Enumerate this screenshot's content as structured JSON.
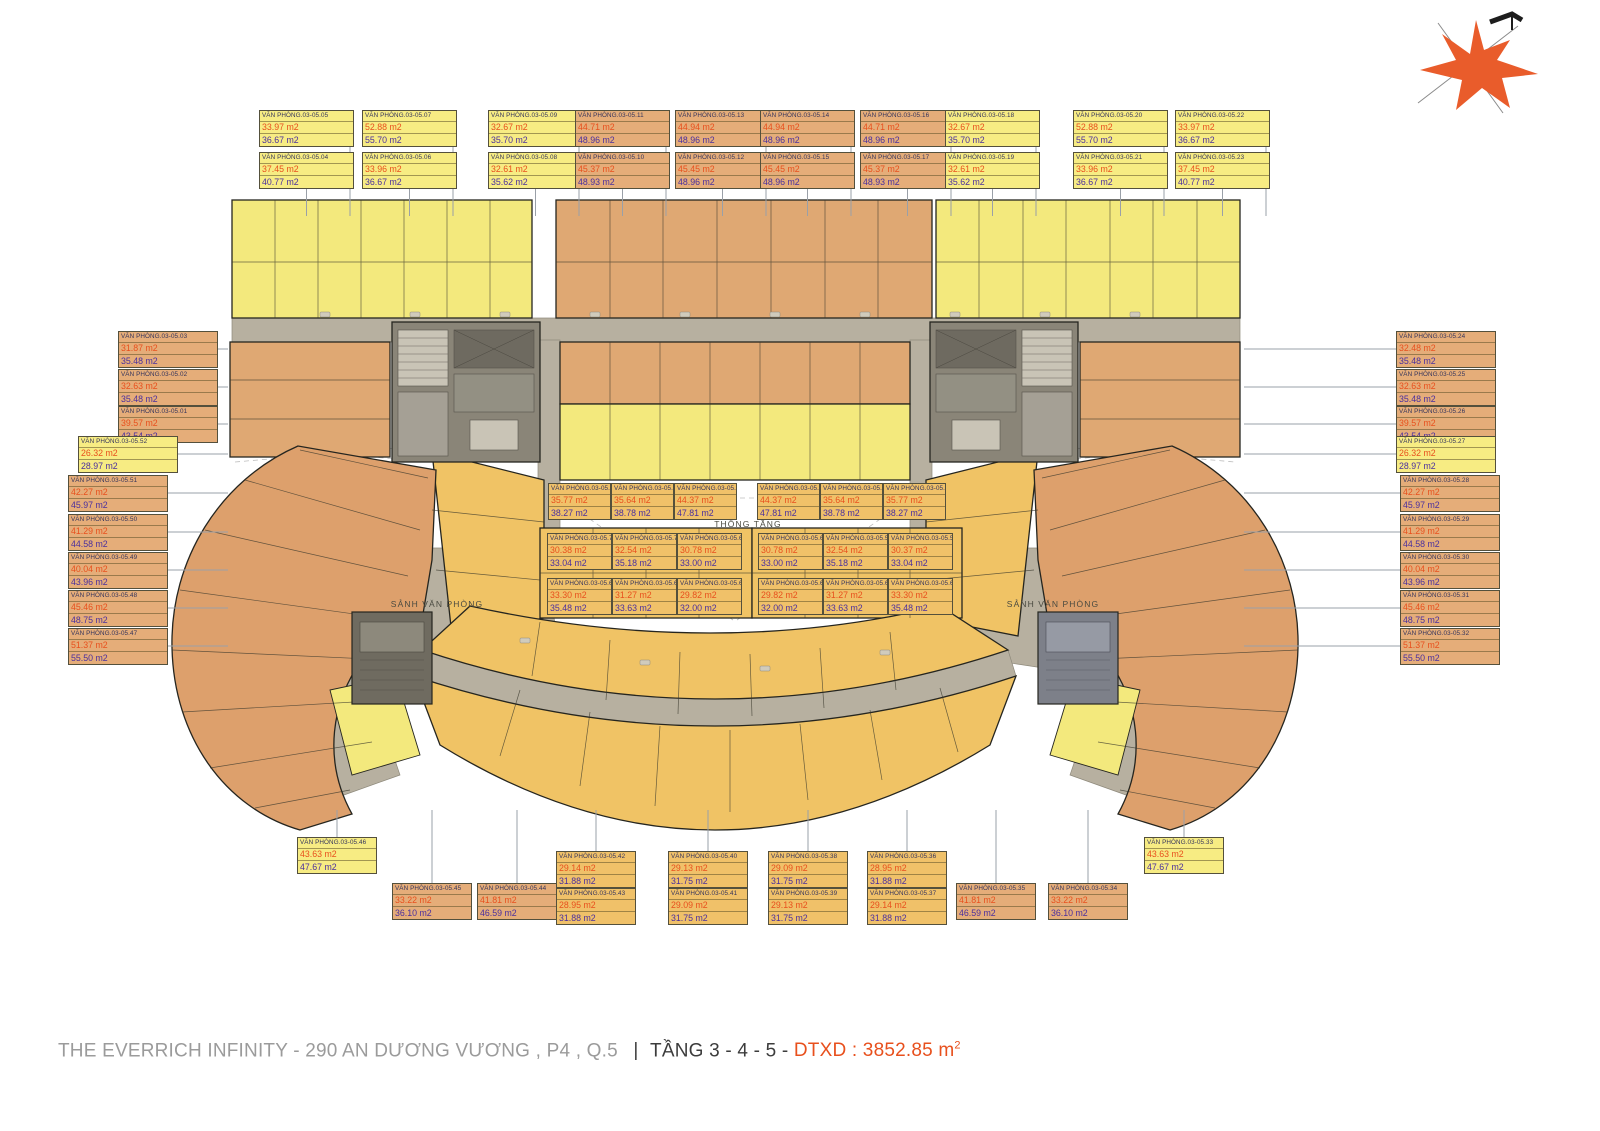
{
  "footer": {
    "project": "THE EVERRICH INFINITY - 290 AN DƯƠNG VƯƠNG , P4 , Q.5",
    "floor": "TẦNG 3 - 4 - 5 - ",
    "dtxd": "DTXD : 3852.85 m",
    "dtxd_sup": "2"
  },
  "colors": {
    "label_yellow": "#f7ec83",
    "label_orange": "#e5ad79",
    "label_golden": "#f0c169",
    "area1_text": "#e8501d",
    "area2_text": "#4a2f9e",
    "name_text": "#33335c",
    "unit_yellow": "#f3e97d",
    "unit_orange": "#dfa873",
    "wing_orange": "#dda06c",
    "unit_golden": "#f0c365",
    "corridor": "#b7b0a0",
    "core": "#8a8578",
    "compass": "#e95c2b",
    "leader": "#9aa0a8"
  },
  "plan_texts": [
    {
      "text": "THÔNG TẦNG",
      "x": 748,
      "y": 524
    },
    {
      "text": "SẢNH VĂN PHÒNG",
      "x": 437,
      "y": 604
    },
    {
      "text": "SẢNH VĂN PHÒNG",
      "x": 1053,
      "y": 604
    }
  ],
  "labels": [
    {
      "id": "VĂN PHÒNG.03-05.05",
      "a1": "33.97 m2",
      "a2": "36.67 m2",
      "c": "yellow",
      "x": 259,
      "y": 110,
      "w": 95,
      "leader": "down"
    },
    {
      "id": "VĂN PHÒNG.03-05.07",
      "a1": "52.88 m2",
      "a2": "55.70 m2",
      "c": "yellow",
      "x": 362,
      "y": 110,
      "w": 95,
      "leader": "down"
    },
    {
      "id": "VĂN PHÒNG.03-05.09",
      "a1": "32.67 m2",
      "a2": "35.70 m2",
      "c": "yellow",
      "x": 488,
      "y": 110,
      "w": 95,
      "leader": "down"
    },
    {
      "id": "VĂN PHÒNG.03-05.11",
      "a1": "44.71 m2",
      "a2": "48.96 m2",
      "c": "orange",
      "x": 575,
      "y": 110,
      "w": 95,
      "leader": "down"
    },
    {
      "id": "VĂN PHÒNG.03-05.13",
      "a1": "44.94 m2",
      "a2": "48.96 m2",
      "c": "orange",
      "x": 675,
      "y": 110,
      "w": 95,
      "leader": "down"
    },
    {
      "id": "VĂN PHÒNG.03-05.14",
      "a1": "44.94 m2",
      "a2": "48.96 m2",
      "c": "orange",
      "x": 760,
      "y": 110,
      "w": 95,
      "leader": "down"
    },
    {
      "id": "VĂN PHÒNG.03-05.16",
      "a1": "44.71 m2",
      "a2": "48.96 m2",
      "c": "orange",
      "x": 860,
      "y": 110,
      "w": 95,
      "leader": "down"
    },
    {
      "id": "VĂN PHÒNG.03-05.18",
      "a1": "32.67 m2",
      "a2": "35.70 m2",
      "c": "yellow",
      "x": 945,
      "y": 110,
      "w": 95,
      "leader": "down"
    },
    {
      "id": "VĂN PHÒNG.03-05.20",
      "a1": "52.88 m2",
      "a2": "55.70 m2",
      "c": "yellow",
      "x": 1073,
      "y": 110,
      "w": 95,
      "leader": "down"
    },
    {
      "id": "VĂN PHÒNG.03-05.22",
      "a1": "33.97 m2",
      "a2": "36.67 m2",
      "c": "yellow",
      "x": 1175,
      "y": 110,
      "w": 95,
      "leader": "down"
    },
    {
      "id": "VĂN PHÒNG.03-05.04",
      "a1": "37.45 m2",
      "a2": "40.77 m2",
      "c": "yellow",
      "x": 259,
      "y": 152,
      "w": 95,
      "leader": "down"
    },
    {
      "id": "VĂN PHÒNG.03-05.06",
      "a1": "33.96 m2",
      "a2": "36.67 m2",
      "c": "yellow",
      "x": 362,
      "y": 152,
      "w": 95,
      "leader": "down"
    },
    {
      "id": "VĂN PHÒNG.03-05.08",
      "a1": "32.61 m2",
      "a2": "35.62 m2",
      "c": "yellow",
      "x": 488,
      "y": 152,
      "w": 95,
      "leader": "down"
    },
    {
      "id": "VĂN PHÒNG.03-05.10",
      "a1": "45.37 m2",
      "a2": "48.93 m2",
      "c": "orange",
      "x": 575,
      "y": 152,
      "w": 95,
      "leader": "down"
    },
    {
      "id": "VĂN PHÒNG.03-05.12",
      "a1": "45.45 m2",
      "a2": "48.96 m2",
      "c": "orange",
      "x": 675,
      "y": 152,
      "w": 95,
      "leader": "down"
    },
    {
      "id": "VĂN PHÒNG.03-05.15",
      "a1": "45.45 m2",
      "a2": "48.96 m2",
      "c": "orange",
      "x": 760,
      "y": 152,
      "w": 95,
      "leader": "down"
    },
    {
      "id": "VĂN PHÒNG.03-05.17",
      "a1": "45.37 m2",
      "a2": "48.93 m2",
      "c": "orange",
      "x": 860,
      "y": 152,
      "w": 95,
      "leader": "down"
    },
    {
      "id": "VĂN PHÒNG.03-05.19",
      "a1": "32.61 m2",
      "a2": "35.62 m2",
      "c": "yellow",
      "x": 945,
      "y": 152,
      "w": 95,
      "leader": "down"
    },
    {
      "id": "VĂN PHÒNG.03-05.21",
      "a1": "33.96 m2",
      "a2": "36.67 m2",
      "c": "yellow",
      "x": 1073,
      "y": 152,
      "w": 95,
      "leader": "down"
    },
    {
      "id": "VĂN PHÒNG.03-05.23",
      "a1": "37.45 m2",
      "a2": "40.77 m2",
      "c": "yellow",
      "x": 1175,
      "y": 152,
      "w": 95,
      "leader": "down"
    },
    {
      "id": "VĂN PHÒNG.03-05.03",
      "a1": "31.87 m2",
      "a2": "35.48 m2",
      "c": "orange",
      "x": 118,
      "y": 331,
      "w": 100,
      "leader": "right"
    },
    {
      "id": "VĂN PHÒNG.03-05.02",
      "a1": "32.63 m2",
      "a2": "35.48 m2",
      "c": "orange",
      "x": 118,
      "y": 369,
      "w": 100,
      "leader": "right"
    },
    {
      "id": "VĂN PHÒNG.03-05.01",
      "a1": "39.57 m2",
      "a2": "43.54 m2",
      "c": "orange",
      "x": 118,
      "y": 406,
      "w": 100,
      "leader": "right"
    },
    {
      "id": "VĂN PHÒNG.03-05.52",
      "a1": "26.32 m2",
      "a2": "28.97 m2",
      "c": "yellow",
      "x": 78,
      "y": 436,
      "w": 100,
      "leader": "right"
    },
    {
      "id": "VĂN PHÒNG.03-05.51",
      "a1": "42.27 m2",
      "a2": "45.97 m2",
      "c": "orange",
      "x": 68,
      "y": 475,
      "w": 100,
      "leader": "right"
    },
    {
      "id": "VĂN PHÒNG.03-05.50",
      "a1": "41.29 m2",
      "a2": "44.58 m2",
      "c": "orange",
      "x": 68,
      "y": 514,
      "w": 100,
      "leader": "right"
    },
    {
      "id": "VĂN PHÒNG.03-05.49",
      "a1": "40.04 m2",
      "a2": "43.96 m2",
      "c": "orange",
      "x": 68,
      "y": 552,
      "w": 100,
      "leader": "right"
    },
    {
      "id": "VĂN PHÒNG.03-05.48",
      "a1": "45.46 m2",
      "a2": "48.75 m2",
      "c": "orange",
      "x": 68,
      "y": 590,
      "w": 100,
      "leader": "right"
    },
    {
      "id": "VĂN PHÒNG.03-05.47",
      "a1": "51.37 m2",
      "a2": "55.50 m2",
      "c": "orange",
      "x": 68,
      "y": 628,
      "w": 100,
      "leader": "right"
    },
    {
      "id": "VĂN PHÒNG.03-05.24",
      "a1": "32.48 m2",
      "a2": "35.48 m2",
      "c": "orange",
      "x": 1396,
      "y": 331,
      "w": 100,
      "leader": "left"
    },
    {
      "id": "VĂN PHÒNG.03-05.25",
      "a1": "32.63 m2",
      "a2": "35.48 m2",
      "c": "orange",
      "x": 1396,
      "y": 369,
      "w": 100,
      "leader": "left"
    },
    {
      "id": "VĂN PHÒNG.03-05.26",
      "a1": "39.57 m2",
      "a2": "43.54 m2",
      "c": "orange",
      "x": 1396,
      "y": 406,
      "w": 100,
      "leader": "left"
    },
    {
      "id": "VĂN PHÒNG.03-05.27",
      "a1": "26.32 m2",
      "a2": "28.97 m2",
      "c": "yellow",
      "x": 1396,
      "y": 436,
      "w": 100,
      "leader": "left"
    },
    {
      "id": "VĂN PHÒNG.03-05.28",
      "a1": "42.27 m2",
      "a2": "45.97 m2",
      "c": "orange",
      "x": 1400,
      "y": 475,
      "w": 100,
      "leader": "left"
    },
    {
      "id": "VĂN PHÒNG.03-05.29",
      "a1": "41.29 m2",
      "a2": "44.58 m2",
      "c": "orange",
      "x": 1400,
      "y": 514,
      "w": 100,
      "leader": "left"
    },
    {
      "id": "VĂN PHÒNG.03-05.30",
      "a1": "40.04 m2",
      "a2": "43.96 m2",
      "c": "orange",
      "x": 1400,
      "y": 552,
      "w": 100,
      "leader": "left"
    },
    {
      "id": "VĂN PHÒNG.03-05.31",
      "a1": "45.46 m2",
      "a2": "48.75 m2",
      "c": "orange",
      "x": 1400,
      "y": 590,
      "w": 100,
      "leader": "left"
    },
    {
      "id": "VĂN PHÒNG.03-05.32",
      "a1": "51.37 m2",
      "a2": "55.50 m2",
      "c": "orange",
      "x": 1400,
      "y": 628,
      "w": 100,
      "leader": "left"
    },
    {
      "id": "VĂN PHÒNG.03-05.72",
      "a1": "35.77 m2",
      "a2": "38.27 m2",
      "c": "golden",
      "x": 548,
      "y": 483,
      "w": 63,
      "leader": "none"
    },
    {
      "id": "VĂN PHÒNG.03-05.53",
      "a1": "35.64 m2",
      "a2": "38.78 m2",
      "c": "golden",
      "x": 611,
      "y": 483,
      "w": 63,
      "leader": "none"
    },
    {
      "id": "VĂN PHÒNG.03-05.54",
      "a1": "44.37 m2",
      "a2": "47.81 m2",
      "c": "golden",
      "x": 674,
      "y": 483,
      "w": 63,
      "leader": "none"
    },
    {
      "id": "VĂN PHÒNG.03-05.55",
      "a1": "44.37 m2",
      "a2": "47.81 m2",
      "c": "golden",
      "x": 757,
      "y": 483,
      "w": 63,
      "leader": "none"
    },
    {
      "id": "VĂN PHÒNG.03-05.56",
      "a1": "35.64 m2",
      "a2": "38.78 m2",
      "c": "golden",
      "x": 820,
      "y": 483,
      "w": 63,
      "leader": "none"
    },
    {
      "id": "VĂN PHÒNG.03-05.57",
      "a1": "35.77 m2",
      "a2": "38.27 m2",
      "c": "golden",
      "x": 883,
      "y": 483,
      "w": 63,
      "leader": "none"
    },
    {
      "id": "VĂN PHÒNG.03-05.70",
      "a1": "30.38 m2",
      "a2": "33.04 m2",
      "c": "golden",
      "x": 547,
      "y": 533,
      "w": 65,
      "leader": "none"
    },
    {
      "id": "VĂN PHÒNG.03-05.71",
      "a1": "32.54 m2",
      "a2": "35.18 m2",
      "c": "golden",
      "x": 612,
      "y": 533,
      "w": 65,
      "leader": "none"
    },
    {
      "id": "VĂN PHÒNG.03-05.65.66",
      "a1": "30.78 m2",
      "a2": "33.00 m2",
      "c": "golden",
      "x": 677,
      "y": 533,
      "w": 65,
      "leader": "none"
    },
    {
      "id": "VĂN PHÒNG.03-05.63.64",
      "a1": "30.78 m2",
      "a2": "33.00 m2",
      "c": "golden",
      "x": 758,
      "y": 533,
      "w": 65,
      "leader": "none"
    },
    {
      "id": "VĂN PHÒNG.03-05.58",
      "a1": "32.54 m2",
      "a2": "35.18 m2",
      "c": "golden",
      "x": 823,
      "y": 533,
      "w": 65,
      "leader": "none"
    },
    {
      "id": "VĂN PHÒNG.03-05.59",
      "a1": "30.37 m2",
      "a2": "33.04 m2",
      "c": "golden",
      "x": 888,
      "y": 533,
      "w": 65,
      "leader": "none"
    },
    {
      "id": "VĂN PHÒNG.03-05.69",
      "a1": "33.30 m2",
      "a2": "35.48 m2",
      "c": "golden",
      "x": 547,
      "y": 578,
      "w": 65,
      "leader": "none"
    },
    {
      "id": "VĂN PHÒNG.03-05.68",
      "a1": "31.27 m2",
      "a2": "33.63 m2",
      "c": "golden",
      "x": 612,
      "y": 578,
      "w": 65,
      "leader": "none"
    },
    {
      "id": "VĂN PHÒNG.03-05.67",
      "a1": "29.82 m2",
      "a2": "32.00 m2",
      "c": "golden",
      "x": 677,
      "y": 578,
      "w": 65,
      "leader": "none"
    },
    {
      "id": "VĂN PHÒNG.03-05.62",
      "a1": "29.82 m2",
      "a2": "32.00 m2",
      "c": "golden",
      "x": 758,
      "y": 578,
      "w": 65,
      "leader": "none"
    },
    {
      "id": "VĂN PHÒNG.03-05.61",
      "a1": "31.27 m2",
      "a2": "33.63 m2",
      "c": "golden",
      "x": 823,
      "y": 578,
      "w": 65,
      "leader": "none"
    },
    {
      "id": "VĂN PHÒNG.03-05.60",
      "a1": "33.30 m2",
      "a2": "35.48 m2",
      "c": "golden",
      "x": 888,
      "y": 578,
      "w": 65,
      "leader": "none"
    },
    {
      "id": "VĂN PHÒNG.03-05.46",
      "a1": "43.63 m2",
      "a2": "47.67 m2",
      "c": "yellow",
      "x": 297,
      "y": 837,
      "w": 80,
      "leader": "up"
    },
    {
      "id": "VĂN PHÒNG.03-05.45",
      "a1": "33.22 m2",
      "a2": "36.10 m2",
      "c": "orange",
      "x": 392,
      "y": 883,
      "w": 80,
      "leader": "up"
    },
    {
      "id": "VĂN PHÒNG.03-05.44",
      "a1": "41.81 m2",
      "a2": "46.59 m2",
      "c": "orange",
      "x": 477,
      "y": 883,
      "w": 80,
      "leader": "up"
    },
    {
      "id": "VĂN PHÒNG.03-05.42",
      "a1": "29.14 m2",
      "a2": "31.88 m2",
      "c": "golden",
      "x": 556,
      "y": 851,
      "w": 80,
      "leader": "up"
    },
    {
      "id": "VĂN PHÒNG.03-05.43",
      "a1": "28.95 m2",
      "a2": "31.88 m2",
      "c": "golden",
      "x": 556,
      "y": 888,
      "w": 80,
      "leader": "up"
    },
    {
      "id": "VĂN PHÒNG.03-05.40",
      "a1": "29.13 m2",
      "a2": "31.75 m2",
      "c": "golden",
      "x": 668,
      "y": 851,
      "w": 80,
      "leader": "up"
    },
    {
      "id": "VĂN PHÒNG.03-05.41",
      "a1": "29.09 m2",
      "a2": "31.75 m2",
      "c": "golden",
      "x": 668,
      "y": 888,
      "w": 80,
      "leader": "up"
    },
    {
      "id": "VĂN PHÒNG.03-05.38",
      "a1": "29.09 m2",
      "a2": "31.75 m2",
      "c": "golden",
      "x": 768,
      "y": 851,
      "w": 80,
      "leader": "up"
    },
    {
      "id": "VĂN PHÒNG.03-05.39",
      "a1": "29.13 m2",
      "a2": "31.75 m2",
      "c": "golden",
      "x": 768,
      "y": 888,
      "w": 80,
      "leader": "up"
    },
    {
      "id": "VĂN PHÒNG.03-05.36",
      "a1": "28.95 m2",
      "a2": "31.88 m2",
      "c": "golden",
      "x": 867,
      "y": 851,
      "w": 80,
      "leader": "up"
    },
    {
      "id": "VĂN PHÒNG.03-05.37",
      "a1": "29.14 m2",
      "a2": "31.88 m2",
      "c": "golden",
      "x": 867,
      "y": 888,
      "w": 80,
      "leader": "up"
    },
    {
      "id": "VĂN PHÒNG.03-05.35",
      "a1": "41.81 m2",
      "a2": "46.59 m2",
      "c": "orange",
      "x": 956,
      "y": 883,
      "w": 80,
      "leader": "up"
    },
    {
      "id": "VĂN PHÒNG.03-05.34",
      "a1": "33.22 m2",
      "a2": "36.10 m2",
      "c": "orange",
      "x": 1048,
      "y": 883,
      "w": 80,
      "leader": "up"
    },
    {
      "id": "VĂN PHÒNG.03-05.33",
      "a1": "43.63 m2",
      "a2": "47.67 m2",
      "c": "yellow",
      "x": 1144,
      "y": 837,
      "w": 80,
      "leader": "up"
    }
  ]
}
